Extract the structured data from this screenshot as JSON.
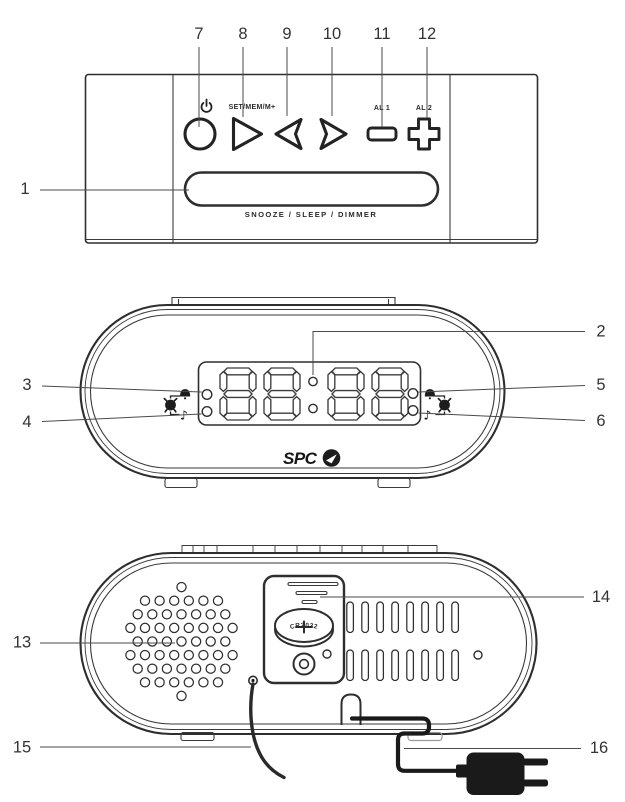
{
  "top_view": {
    "set_button_label": "SET/MEM/M+",
    "alarm1_button_label": "AL 1",
    "alarm2_button_label": "AL 2",
    "snooze_bar_label": "SNOOZE / SLEEP / DIMMER"
  },
  "front_view": {
    "display_value": "88:88",
    "brand": "SPC"
  },
  "back_view": {
    "battery_label": "CR2032"
  },
  "callouts": [
    "1",
    "2",
    "3",
    "4",
    "5",
    "6",
    "7",
    "8",
    "9",
    "10",
    "11",
    "12",
    "13",
    "14",
    "15",
    "16"
  ],
  "colors": {
    "line": "#2e2e2e",
    "black": "#1a1a1a",
    "callout_text": "#333333",
    "background": "#ffffff"
  }
}
